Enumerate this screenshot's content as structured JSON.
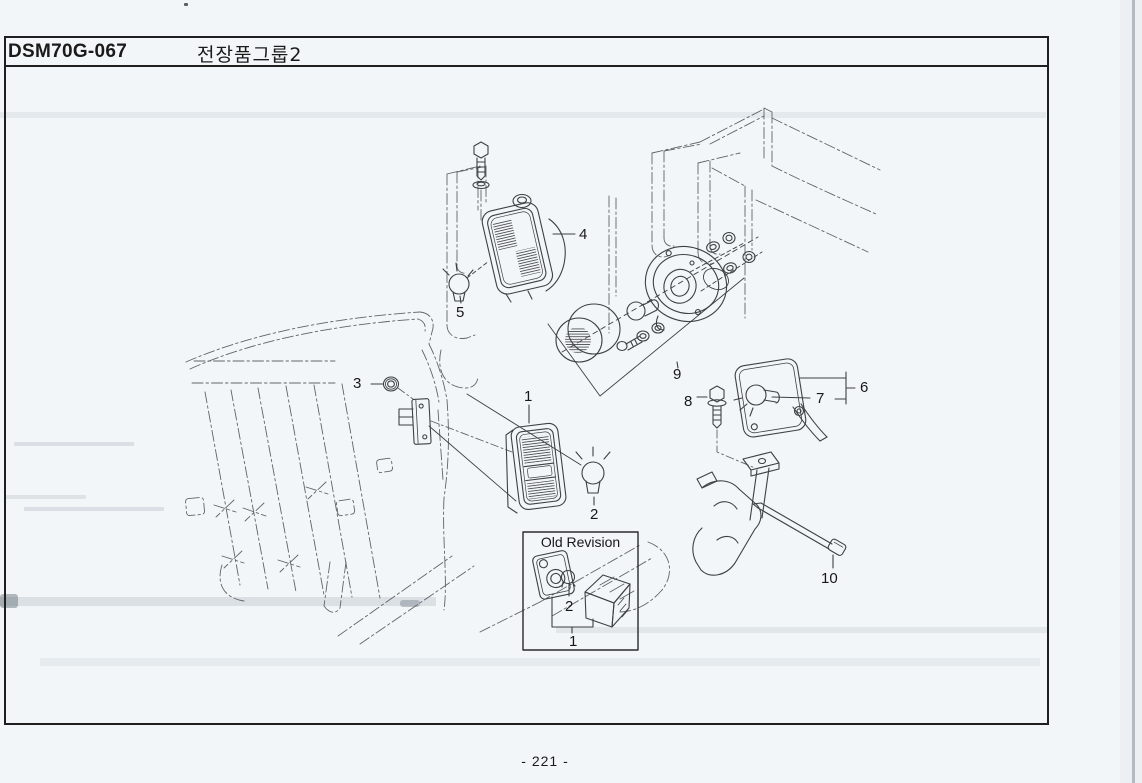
{
  "colors": {
    "paper": "#f3f6f8",
    "ink": "#1a1a1a",
    "line": "#3d4045",
    "phantom_line": "#60646a",
    "border": "#1f1f1f"
  },
  "header": {
    "part_code": "DSM70G-067",
    "title": "전장품그룹2"
  },
  "footer": {
    "page_label": "- 221 -"
  },
  "diagram": {
    "callouts": {
      "c1": "1",
      "c2": "2",
      "c3": "3",
      "c4": "4",
      "c5": "5",
      "c6": "6",
      "c7": "7",
      "c8": "8",
      "c9": "9",
      "c10": "10"
    },
    "old_revision": {
      "title": "Old Revision",
      "bulb_callout": "2",
      "lamp_callout": "1"
    }
  }
}
